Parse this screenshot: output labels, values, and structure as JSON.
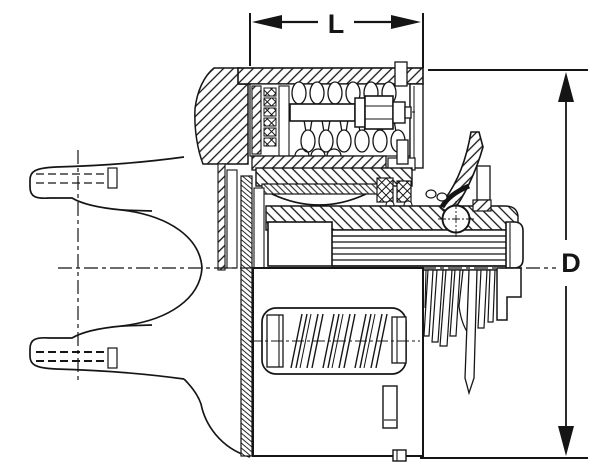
{
  "figure": {
    "type": "technical-cross-section",
    "subject": "friction clutch assembly on universal-joint yoke",
    "background_color": "#ffffff",
    "ink_color": "#151515",
    "dimension_labels": {
      "length": "L",
      "diameter": "D"
    },
    "components": [
      "universal-joint-yoke",
      "yoke-flange",
      "spring-housing",
      "coil-spring",
      "adjusting-bolt-with-hex-head",
      "friction-plate-stack",
      "clutch-disc-pack",
      "diaphragm-spring-arc",
      "seal-blocks",
      "pressure-plate",
      "release-lever",
      "release-ball-bearing",
      "splined-hub-shaft",
      "end-cap",
      "bell-housing",
      "window-spring",
      "disc-fingers",
      "dimension-L",
      "dimension-D"
    ]
  }
}
